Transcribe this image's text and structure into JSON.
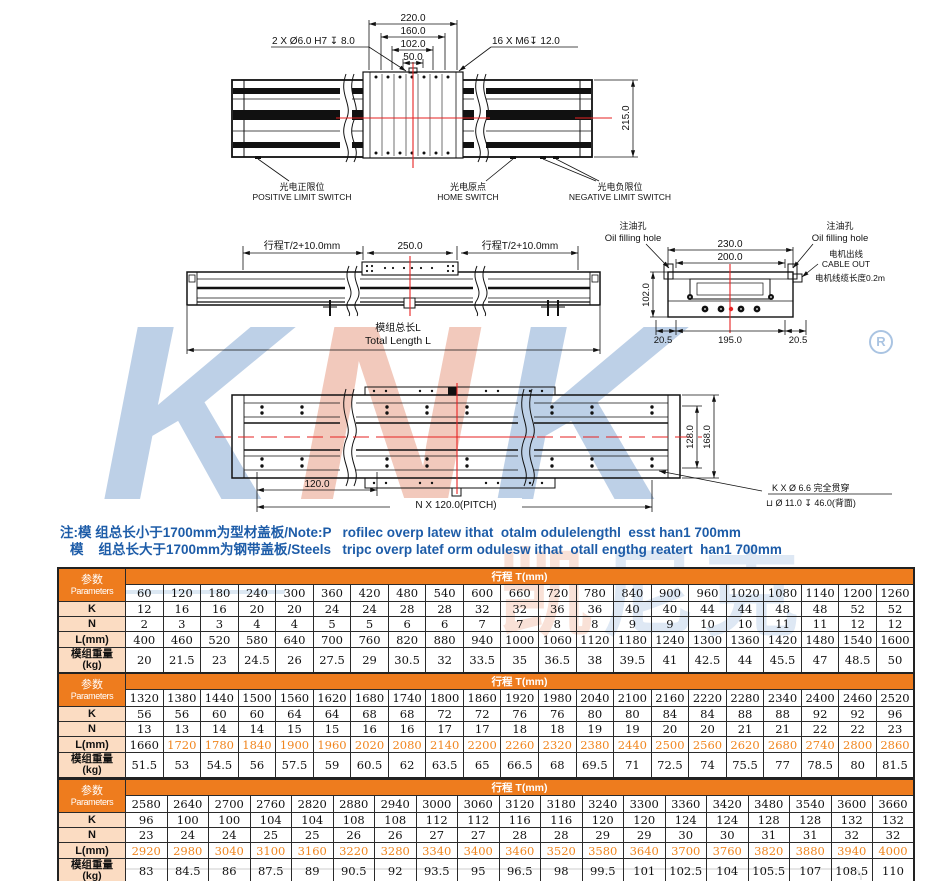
{
  "colors": {
    "header_orange": "#ee7c1e",
    "label_peach": "#fbdcc2",
    "l_highlight_orange": "#f0861f",
    "note_blue": "#1d5ca8",
    "watermark_blue": "#bdd0e7",
    "watermark_salmon": "#f2c9bc",
    "centerline_red": "#e62222"
  },
  "watermark": {
    "k1": "K",
    "n": "N",
    "k2": "K",
    "registered": "R",
    "cn1": "凯",
    "cn2": "尼克"
  },
  "drawings": {
    "top_view": {
      "dim_220": "220.0",
      "dim_160": "160.0",
      "dim_102": "102.0",
      "dim_50": "50.0",
      "dim_215": "215.0",
      "note_left": "2 X Ø6.0 H7 ↧ 8.0",
      "note_right": "16 X M6↧ 12.0",
      "positive_limit_cn": "光电正限位",
      "positive_limit_en": "POSITIVE LIMIT SWITCH",
      "home_cn": "光电原点",
      "home_en": "HOME  SWITCH",
      "negative_limit_cn": "光电负限位",
      "negative_limit_en": "NEGATIVE  LIMIT  SWITCH"
    },
    "side_view": {
      "stroke_left": "行程T/2+10.0mm",
      "center": "250.0",
      "stroke_right": "行程T/2+10.0mm",
      "total_cn": "模组总长L",
      "total_en": "Total Length L"
    },
    "section_view": {
      "oil_left_cn": "注油孔",
      "oil_left_en": "Oil filling hole",
      "oil_right_cn": "注油孔",
      "oil_right_en": "Oil filling hole",
      "cable_cn": "电机出线",
      "cable_en": "CABLE OUT",
      "cable_len": "电机线缆长度0.2m",
      "dim_230": "230.0",
      "dim_200": "200.0",
      "dim_102": "102.0",
      "dim_205_left": "20.5",
      "dim_195": "195.0",
      "dim_205_right": "20.5"
    },
    "bottom_view": {
      "dim_120": "120.0",
      "pitch": "N X 120.0(PITCH)",
      "dim_128": "128.0",
      "dim_168": "168.0",
      "hole_note1": "K X Ø 6.6 完全贯穿",
      "hole_note2": "⊔ Ø 11.0 ↧ 46.0(背面)"
    }
  },
  "notes": {
    "line1": "注:模 组总长小于1700mm为型材盖板/Note:P   rofilec overp latew ithat  otalm odulelengthl  esst han1 700mm",
    "line2": "模    组总长大于1700mm为钢带盖板/Steels   tripc overp latef orm odulesw ithat  otall engthg reatert  han1 700mm"
  },
  "tables": [
    {
      "corner_cn": "参数",
      "corner_en": "Parameters",
      "stroke_header": "行程 T(mm)",
      "columns": [
        60,
        120,
        180,
        240,
        300,
        360,
        420,
        480,
        540,
        600,
        660,
        720,
        780,
        840,
        900,
        960,
        1020,
        1080,
        1140,
        1200,
        1260
      ],
      "rows": [
        {
          "label": "K",
          "values": [
            12,
            16,
            16,
            20,
            20,
            24,
            24,
            28,
            28,
            32,
            32,
            36,
            36,
            40,
            40,
            44,
            44,
            48,
            48,
            52,
            52
          ]
        },
        {
          "label": "N",
          "values": [
            2,
            3,
            3,
            4,
            4,
            5,
            5,
            6,
            6,
            7,
            7,
            8,
            8,
            9,
            9,
            10,
            10,
            11,
            11,
            12,
            12
          ]
        },
        {
          "label": "L(mm)",
          "values": [
            400,
            460,
            520,
            580,
            640,
            700,
            760,
            820,
            880,
            940,
            1000,
            1060,
            1120,
            1180,
            1240,
            1300,
            1360,
            1420,
            1480,
            1540,
            1600
          ]
        },
        {
          "label": "模组重量",
          "label2": "(kg)",
          "values": [
            20,
            21.5,
            23,
            24.5,
            26,
            27.5,
            29,
            30.5,
            32,
            33.5,
            35,
            36.5,
            38,
            39.5,
            41,
            42.5,
            44,
            45.5,
            47,
            48.5,
            50
          ]
        }
      ]
    },
    {
      "corner_cn": "参数",
      "corner_en": "Parameters",
      "stroke_header": "行程 T(mm)",
      "columns": [
        1320,
        1380,
        1440,
        1500,
        1560,
        1620,
        1680,
        1740,
        1800,
        1860,
        1920,
        1980,
        2040,
        2100,
        2160,
        2220,
        2280,
        2340,
        2400,
        2460,
        2520
      ],
      "rows": [
        {
          "label": "K",
          "values": [
            56,
            56,
            60,
            60,
            64,
            64,
            68,
            68,
            72,
            72,
            76,
            76,
            80,
            80,
            84,
            84,
            88,
            88,
            92,
            92,
            96
          ]
        },
        {
          "label": "N",
          "values": [
            13,
            13,
            14,
            14,
            15,
            15,
            16,
            16,
            17,
            17,
            18,
            18,
            19,
            19,
            20,
            20,
            21,
            21,
            22,
            22,
            23
          ]
        },
        {
          "label": "L(mm)",
          "orange_from": 1,
          "values": [
            1660,
            1720,
            1780,
            1840,
            1900,
            1960,
            2020,
            2080,
            2140,
            2200,
            2260,
            2320,
            2380,
            2440,
            2500,
            2560,
            2620,
            2680,
            2740,
            2800,
            2860
          ]
        },
        {
          "label": "模组重量",
          "label2": "(kg)",
          "values": [
            51.5,
            53,
            54.5,
            56,
            57.5,
            59,
            60.5,
            62,
            63.5,
            65,
            66.5,
            68,
            69.5,
            71,
            72.5,
            74,
            75.5,
            77,
            78.5,
            80,
            81.5
          ]
        }
      ]
    },
    {
      "corner_cn": "参数",
      "corner_en": "Parameters",
      "stroke_header": "行程 T(mm)",
      "columns": [
        2580,
        2640,
        2700,
        2760,
        2820,
        2880,
        2940,
        3000,
        3060,
        3120,
        3180,
        3240,
        3300,
        3360,
        3420,
        3480,
        3540,
        3600,
        3660
      ],
      "rows": [
        {
          "label": "K",
          "values": [
            96,
            100,
            100,
            104,
            104,
            108,
            108,
            112,
            112,
            116,
            116,
            120,
            120,
            124,
            124,
            128,
            128,
            132,
            132
          ]
        },
        {
          "label": "N",
          "values": [
            23,
            24,
            24,
            25,
            25,
            26,
            26,
            27,
            27,
            28,
            28,
            29,
            29,
            30,
            30,
            31,
            31,
            32,
            32
          ]
        },
        {
          "label": "L(mm)",
          "orange_from": 0,
          "values": [
            2920,
            2980,
            3040,
            3100,
            3160,
            3220,
            3280,
            3340,
            3400,
            3460,
            3520,
            3580,
            3640,
            3700,
            3760,
            3820,
            3880,
            3940,
            4000
          ]
        },
        {
          "label": "模组重量",
          "label2": "(kg)",
          "values": [
            83,
            84.5,
            86,
            87.5,
            89,
            90.5,
            92,
            93.5,
            95,
            96.5,
            98,
            99.5,
            101,
            102.5,
            104,
            105.5,
            107,
            108.5,
            110
          ]
        }
      ]
    }
  ]
}
